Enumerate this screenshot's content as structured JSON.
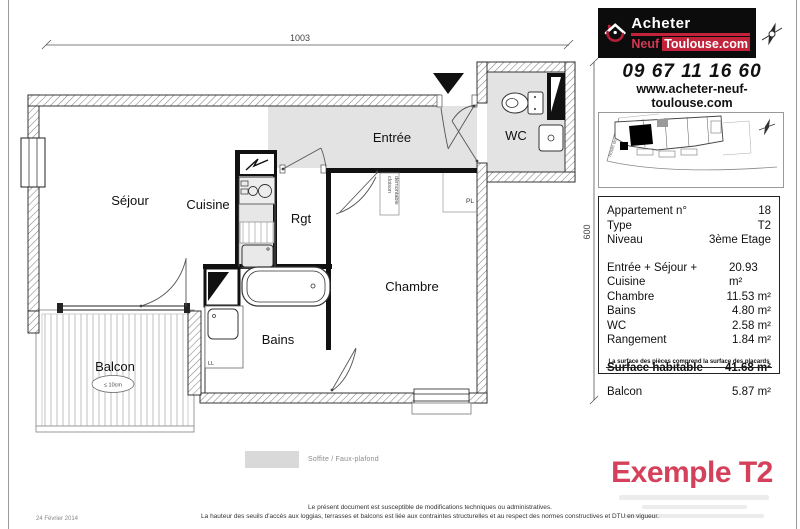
{
  "branding": {
    "logo": {
      "word1": "Acheter",
      "word2": "Neuf",
      "word3": "Toulouse.com"
    },
    "phone": "09 67 11 16 60",
    "website": "www.acheter-neuf-toulouse.com"
  },
  "sidebar": {
    "info": {
      "rows_head": [
        {
          "label": "Appartement n°",
          "value": "18"
        },
        {
          "label": "Type",
          "value": "T2"
        },
        {
          "label": "Niveau",
          "value": "3ème Etage"
        }
      ],
      "rows_areas": [
        {
          "label": "Entrée + Séjour + Cuisine",
          "value": "20.93 m²"
        },
        {
          "label": "Chambre",
          "value": "11.53 m²"
        },
        {
          "label": "Bains",
          "value": "4.80 m²"
        },
        {
          "label": "WC",
          "value": "2.58 m²"
        },
        {
          "label": "Rangement",
          "value": "1.84 m²"
        }
      ],
      "total": {
        "label": "Surface habitable",
        "value": "41.68 m²"
      },
      "balcon": {
        "label": "Balcon",
        "value": "5.87 m²"
      },
      "footnote": "La surface des pièces comprend la surface des placards"
    },
    "example_title": "Exemple T2",
    "minimap_road": "Route de"
  },
  "plan": {
    "dims": {
      "width": "1003",
      "height": "600"
    },
    "rooms": {
      "sejour": "Séjour",
      "cuisine": "Cuisine",
      "rgt": "Rgt",
      "entree": "Entrée",
      "wc": "WC",
      "chambre": "Chambre",
      "bains": "Bains",
      "balcon": "Balcon"
    },
    "annotations": {
      "pl": "PL",
      "ll": "LL",
      "cloison_line1": "cloison",
      "cloison_line2": "démontable",
      "balcon_note": "≤ 10cm"
    }
  },
  "legend": {
    "soffite": "Soffite / Faux-plafond"
  },
  "footer": {
    "date": "24 Février 2014",
    "line1": "Le présent document est susceptible de modifications techniques ou administratives.",
    "line2": "La hauteur des seuils d'accès aux loggias, terrasses et balcons est liée aux contraintes structurelles et au respect des normes constructives et DTU en vigueur."
  }
}
